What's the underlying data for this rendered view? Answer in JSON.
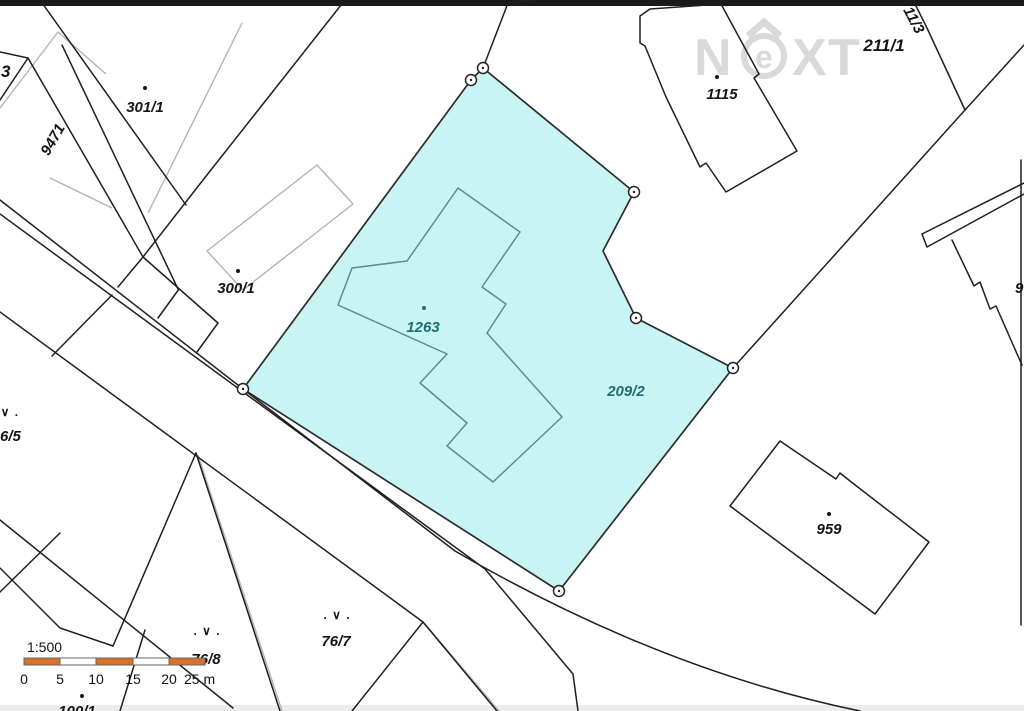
{
  "map": {
    "labels": {
      "p3": "3",
      "p9471": "9471",
      "p301_1": "301/1",
      "p300_1": "300/1",
      "b1115": "1115",
      "p211_1": "211/1",
      "p11_3": "11/3",
      "p9cut": "9",
      "b1263": "1263",
      "p209_2": "209/2",
      "b959": "959",
      "p76_5": "6/5",
      "p76_7": "76/7",
      "p76_8": "76/8",
      "p100_1": "100/1"
    },
    "symbols": {
      "landuse": ". ∨ ."
    },
    "scalebar": {
      "ratio": "1:500",
      "t0": "0",
      "t5": "5",
      "t10": "10",
      "t15": "15",
      "t20": "20",
      "t25": "25 m"
    },
    "watermark": {
      "n": "N",
      "e": "e",
      "x": "X",
      "t": "T"
    },
    "colors": {
      "highlight_fill": "#c9f4f4",
      "teal_label": "#1d6e6e",
      "scalebar_orange": "#d8702c",
      "watermark_gray": "#d7d7d7",
      "line_black": "#1f1f1f",
      "line_gray": "#b3b3b3"
    }
  }
}
